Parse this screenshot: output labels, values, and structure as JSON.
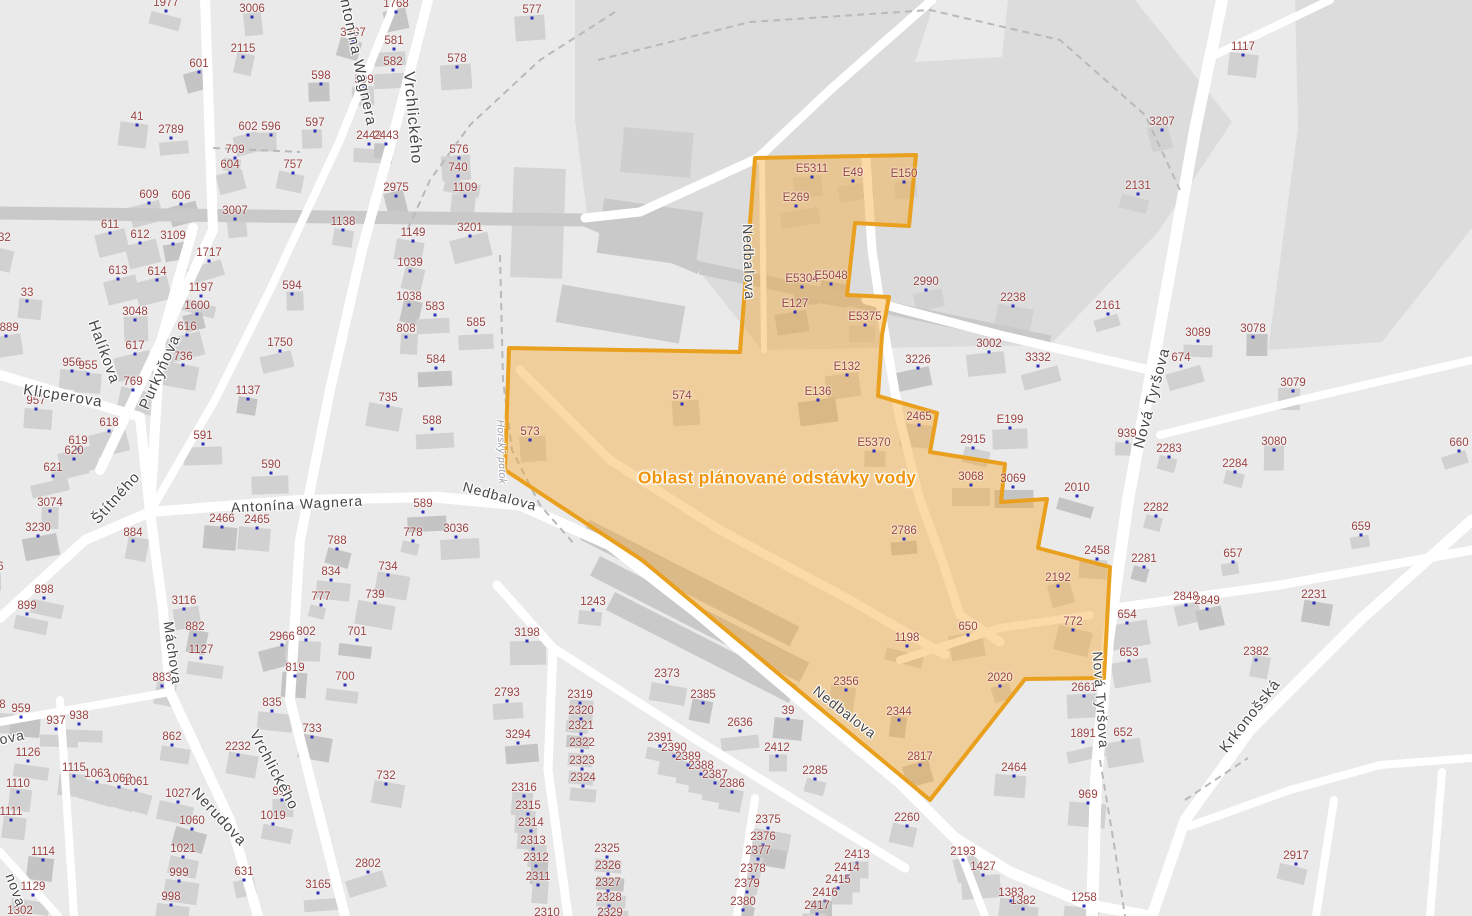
{
  "map": {
    "outage": {
      "label": "Oblast plánované odstávky vody",
      "x": 777,
      "y": 478
    },
    "colors": {
      "background": "#eaeaea",
      "zone_dark": "#dcdcdc",
      "street_white": "#ffffff",
      "road_gray": "#c9c9c9",
      "dashed_path": "#b9b9b9",
      "building": "#d1d1d1",
      "building_dark": "#c4c4c4",
      "parcel_text": "#9a4141",
      "marker_dot": "#2e2eb8",
      "street_text": "#454545",
      "outage_fill": "rgba(245,167,45,0.42)",
      "outage_border": "#e9a01e",
      "outage_text": "#f0950c"
    },
    "street_labels": [
      {
        "t": "Antonína Wagnera",
        "x": 357,
        "y": 57,
        "r": 78,
        "s": 15
      },
      {
        "t": "Vrchlického",
        "x": 412,
        "y": 118,
        "r": 85,
        "s": 16
      },
      {
        "t": "Halíkova",
        "x": 104,
        "y": 352,
        "r": 70,
        "s": 15
      },
      {
        "t": "Purkyňova",
        "x": 160,
        "y": 372,
        "r": -66,
        "s": 15
      },
      {
        "t": "Klicperova",
        "x": 63,
        "y": 396,
        "r": 9,
        "s": 15
      },
      {
        "t": "Štítného",
        "x": 116,
        "y": 498,
        "r": -48,
        "s": 15
      },
      {
        "t": "Antonína Wagnera",
        "x": 297,
        "y": 504,
        "r": -3,
        "s": 14
      },
      {
        "t": "Nedbalova",
        "x": 500,
        "y": 496,
        "r": 15,
        "s": 14
      },
      {
        "t": "Nedbalova",
        "x": 749,
        "y": 262,
        "r": 88,
        "s": 14
      },
      {
        "t": "Nedbalova",
        "x": 845,
        "y": 712,
        "r": 38,
        "s": 14
      },
      {
        "t": "Nová Tyršova",
        "x": 1152,
        "y": 398,
        "r": -75,
        "s": 15
      },
      {
        "t": "Nová Tyršova",
        "x": 1101,
        "y": 700,
        "r": 86,
        "s": 14
      },
      {
        "t": "Krkonošská",
        "x": 1250,
        "y": 716,
        "r": -52,
        "s": 15
      },
      {
        "t": "Nerudova",
        "x": 219,
        "y": 817,
        "r": 47,
        "s": 15
      },
      {
        "t": "Vrchlického",
        "x": 274,
        "y": 770,
        "r": 62,
        "s": 15
      },
      {
        "t": "Máchova",
        "x": 173,
        "y": 653,
        "r": 82,
        "s": 14
      },
      {
        "t": "ova",
        "x": 12,
        "y": 737,
        "r": -12,
        "s": 14
      },
      {
        "t": "nova",
        "x": 16,
        "y": 890,
        "r": 70,
        "s": 14
      },
      {
        "t": "Horský potok",
        "x": 501,
        "y": 452,
        "r": 88,
        "s": 10,
        "water": true
      }
    ],
    "parcel_labels": [
      {
        "t": "1977",
        "x": 166,
        "y": 3
      },
      {
        "t": "3006",
        "x": 252,
        "y": 9
      },
      {
        "t": "2115",
        "x": 243,
        "y": 49
      },
      {
        "t": "601",
        "x": 199,
        "y": 64
      },
      {
        "t": "41",
        "x": 137,
        "y": 117
      },
      {
        "t": "2789",
        "x": 171,
        "y": 130
      },
      {
        "t": "602",
        "x": 248,
        "y": 127
      },
      {
        "t": "596",
        "x": 271,
        "y": 127
      },
      {
        "t": "709",
        "x": 235,
        "y": 150
      },
      {
        "t": "604",
        "x": 230,
        "y": 165
      },
      {
        "t": "757",
        "x": 293,
        "y": 165
      },
      {
        "t": "609",
        "x": 149,
        "y": 195
      },
      {
        "t": "606",
        "x": 181,
        "y": 196
      },
      {
        "t": "3007",
        "x": 235,
        "y": 211
      },
      {
        "t": "611",
        "x": 110,
        "y": 225
      },
      {
        "t": "1032",
        "x": -2,
        "y": 238
      },
      {
        "t": "612",
        "x": 140,
        "y": 235
      },
      {
        "t": "3109",
        "x": 173,
        "y": 236
      },
      {
        "t": "1717",
        "x": 209,
        "y": 253
      },
      {
        "t": "613",
        "x": 118,
        "y": 271
      },
      {
        "t": "614",
        "x": 157,
        "y": 272
      },
      {
        "t": "594",
        "x": 292,
        "y": 286
      },
      {
        "t": "1197",
        "x": 201,
        "y": 288
      },
      {
        "t": "1600",
        "x": 197,
        "y": 306
      },
      {
        "t": "3048",
        "x": 135,
        "y": 312
      },
      {
        "t": "2889",
        "x": 6,
        "y": 328
      },
      {
        "t": "616",
        "x": 187,
        "y": 327
      },
      {
        "t": "33",
        "x": 27,
        "y": 293
      },
      {
        "t": "617",
        "x": 135,
        "y": 346
      },
      {
        "t": "1750",
        "x": 280,
        "y": 343
      },
      {
        "t": "736",
        "x": 183,
        "y": 357
      },
      {
        "t": "956",
        "x": 72,
        "y": 363
      },
      {
        "t": "955",
        "x": 88,
        "y": 366
      },
      {
        "t": "769",
        "x": 133,
        "y": 382
      },
      {
        "t": "1137",
        "x": 248,
        "y": 391
      },
      {
        "t": "957",
        "x": 36,
        "y": 401
      },
      {
        "t": "618",
        "x": 109,
        "y": 423
      },
      {
        "t": "619",
        "x": 78,
        "y": 441
      },
      {
        "t": "620",
        "x": 74,
        "y": 451
      },
      {
        "t": "591",
        "x": 203,
        "y": 436
      },
      {
        "t": "621",
        "x": 53,
        "y": 468
      },
      {
        "t": "590",
        "x": 271,
        "y": 465
      },
      {
        "t": "3074",
        "x": 50,
        "y": 503
      },
      {
        "t": "3230",
        "x": 38,
        "y": 528
      },
      {
        "t": "326",
        "x": -6,
        "y": 567
      },
      {
        "t": "898",
        "x": 44,
        "y": 590
      },
      {
        "t": "899",
        "x": 27,
        "y": 606
      },
      {
        "t": "884",
        "x": 133,
        "y": 533
      },
      {
        "t": "2466",
        "x": 222,
        "y": 519
      },
      {
        "t": "2465",
        "x": 257,
        "y": 520
      },
      {
        "t": "3116",
        "x": 184,
        "y": 601
      },
      {
        "t": "882",
        "x": 195,
        "y": 627
      },
      {
        "t": "1127",
        "x": 201,
        "y": 650
      },
      {
        "t": "883",
        "x": 162,
        "y": 678
      },
      {
        "t": "2966",
        "x": 282,
        "y": 637
      },
      {
        "t": "819",
        "x": 295,
        "y": 668
      },
      {
        "t": "802",
        "x": 306,
        "y": 632
      },
      {
        "t": "835",
        "x": 272,
        "y": 703
      },
      {
        "t": "958",
        "x": -4,
        "y": 705
      },
      {
        "t": "959",
        "x": 21,
        "y": 709
      },
      {
        "t": "937",
        "x": 56,
        "y": 721
      },
      {
        "t": "938",
        "x": 79,
        "y": 716
      },
      {
        "t": "1126",
        "x": 28,
        "y": 753
      },
      {
        "t": "1110",
        "x": 18,
        "y": 784
      },
      {
        "t": "1111",
        "x": 11,
        "y": 812
      },
      {
        "t": "1115",
        "x": 74,
        "y": 768
      },
      {
        "t": "1063",
        "x": 97,
        "y": 774
      },
      {
        "t": "1062",
        "x": 119,
        "y": 779
      },
      {
        "t": "1061",
        "x": 136,
        "y": 782
      },
      {
        "t": "1114",
        "x": 43,
        "y": 852
      },
      {
        "t": "1129",
        "x": 33,
        "y": 887
      },
      {
        "t": "1302",
        "x": 20,
        "y": 911
      },
      {
        "t": "862",
        "x": 172,
        "y": 737
      },
      {
        "t": "1027",
        "x": 178,
        "y": 794
      },
      {
        "t": "1060",
        "x": 192,
        "y": 821
      },
      {
        "t": "1021",
        "x": 183,
        "y": 849
      },
      {
        "t": "999",
        "x": 179,
        "y": 873
      },
      {
        "t": "998",
        "x": 171,
        "y": 897
      },
      {
        "t": "2232",
        "x": 238,
        "y": 747
      },
      {
        "t": "914",
        "x": 282,
        "y": 792
      },
      {
        "t": "1019",
        "x": 273,
        "y": 816
      },
      {
        "t": "631",
        "x": 244,
        "y": 872
      },
      {
        "t": "732",
        "x": 386,
        "y": 776
      },
      {
        "t": "3165",
        "x": 318,
        "y": 885
      },
      {
        "t": "2802",
        "x": 368,
        "y": 864
      },
      {
        "t": "700",
        "x": 345,
        "y": 677
      },
      {
        "t": "733",
        "x": 312,
        "y": 729
      },
      {
        "t": "3307",
        "x": 353,
        "y": 33
      },
      {
        "t": "1768",
        "x": 396,
        "y": 4
      },
      {
        "t": "581",
        "x": 394,
        "y": 41
      },
      {
        "t": "582",
        "x": 393,
        "y": 62
      },
      {
        "t": "598",
        "x": 321,
        "y": 76
      },
      {
        "t": "599",
        "x": 364,
        "y": 80
      },
      {
        "t": "597",
        "x": 315,
        "y": 123
      },
      {
        "t": "2442",
        "x": 369,
        "y": 136
      },
      {
        "t": "2443",
        "x": 386,
        "y": 136
      },
      {
        "t": "577",
        "x": 532,
        "y": 10
      },
      {
        "t": "578",
        "x": 457,
        "y": 59
      },
      {
        "t": "576",
        "x": 459,
        "y": 150
      },
      {
        "t": "740",
        "x": 458,
        "y": 168
      },
      {
        "t": "1109",
        "x": 465,
        "y": 188
      },
      {
        "t": "2975",
        "x": 396,
        "y": 188
      },
      {
        "t": "1138",
        "x": 343,
        "y": 222
      },
      {
        "t": "3201",
        "x": 470,
        "y": 228
      },
      {
        "t": "1149",
        "x": 413,
        "y": 233
      },
      {
        "t": "1039",
        "x": 410,
        "y": 263
      },
      {
        "t": "1038",
        "x": 409,
        "y": 297
      },
      {
        "t": "583",
        "x": 435,
        "y": 307
      },
      {
        "t": "808",
        "x": 406,
        "y": 329
      },
      {
        "t": "585",
        "x": 476,
        "y": 323
      },
      {
        "t": "584",
        "x": 436,
        "y": 360
      },
      {
        "t": "735",
        "x": 388,
        "y": 398
      },
      {
        "t": "588",
        "x": 432,
        "y": 421
      },
      {
        "t": "573",
        "x": 530,
        "y": 432
      },
      {
        "t": "589",
        "x": 423,
        "y": 504
      },
      {
        "t": "778",
        "x": 413,
        "y": 533
      },
      {
        "t": "3036",
        "x": 456,
        "y": 529
      },
      {
        "t": "788",
        "x": 337,
        "y": 541
      },
      {
        "t": "834",
        "x": 331,
        "y": 572
      },
      {
        "t": "734",
        "x": 388,
        "y": 567
      },
      {
        "t": "739",
        "x": 375,
        "y": 595
      },
      {
        "t": "777",
        "x": 321,
        "y": 597
      },
      {
        "t": "701",
        "x": 357,
        "y": 632
      },
      {
        "t": "3198",
        "x": 527,
        "y": 633
      },
      {
        "t": "2793",
        "x": 507,
        "y": 693
      },
      {
        "t": "3294",
        "x": 518,
        "y": 735
      },
      {
        "t": "1243",
        "x": 593,
        "y": 602
      },
      {
        "t": "2373",
        "x": 667,
        "y": 674
      },
      {
        "t": "2385",
        "x": 703,
        "y": 695
      },
      {
        "t": "2319",
        "x": 580,
        "y": 695
      },
      {
        "t": "2320",
        "x": 581,
        "y": 711
      },
      {
        "t": "2321",
        "x": 581,
        "y": 726
      },
      {
        "t": "2322",
        "x": 582,
        "y": 743
      },
      {
        "t": "2323",
        "x": 582,
        "y": 761
      },
      {
        "t": "2324",
        "x": 583,
        "y": 778
      },
      {
        "t": "2391",
        "x": 660,
        "y": 738
      },
      {
        "t": "2390",
        "x": 674,
        "y": 748
      },
      {
        "t": "2389",
        "x": 688,
        "y": 757
      },
      {
        "t": "2388",
        "x": 701,
        "y": 766
      },
      {
        "t": "2387",
        "x": 715,
        "y": 775
      },
      {
        "t": "2386",
        "x": 732,
        "y": 784
      },
      {
        "t": "2636",
        "x": 740,
        "y": 723
      },
      {
        "t": "39",
        "x": 788,
        "y": 711
      },
      {
        "t": "2412",
        "x": 777,
        "y": 748
      },
      {
        "t": "2285",
        "x": 815,
        "y": 771
      },
      {
        "t": "2356",
        "x": 846,
        "y": 682
      },
      {
        "t": "2344",
        "x": 899,
        "y": 712
      },
      {
        "t": "2316",
        "x": 524,
        "y": 788
      },
      {
        "t": "2315",
        "x": 528,
        "y": 806
      },
      {
        "t": "2314",
        "x": 531,
        "y": 823
      },
      {
        "t": "2313",
        "x": 533,
        "y": 841
      },
      {
        "t": "2312",
        "x": 536,
        "y": 858
      },
      {
        "t": "2311",
        "x": 538,
        "y": 877
      },
      {
        "t": "2310",
        "x": 547,
        "y": 913
      },
      {
        "t": "2325",
        "x": 607,
        "y": 849
      },
      {
        "t": "2326",
        "x": 608,
        "y": 866
      },
      {
        "t": "2327",
        "x": 608,
        "y": 883
      },
      {
        "t": "2328",
        "x": 609,
        "y": 898
      },
      {
        "t": "2329",
        "x": 610,
        "y": 913
      },
      {
        "t": "2375",
        "x": 768,
        "y": 820
      },
      {
        "t": "2376",
        "x": 763,
        "y": 837
      },
      {
        "t": "2377",
        "x": 758,
        "y": 851
      },
      {
        "t": "2378",
        "x": 753,
        "y": 869
      },
      {
        "t": "2379",
        "x": 747,
        "y": 884
      },
      {
        "t": "2380",
        "x": 743,
        "y": 902
      },
      {
        "t": "2413",
        "x": 857,
        "y": 855
      },
      {
        "t": "2414",
        "x": 847,
        "y": 868
      },
      {
        "t": "2415",
        "x": 838,
        "y": 880
      },
      {
        "t": "2416",
        "x": 825,
        "y": 893
      },
      {
        "t": "2417",
        "x": 817,
        "y": 906
      },
      {
        "t": "2260",
        "x": 907,
        "y": 818
      },
      {
        "t": "2193",
        "x": 963,
        "y": 852
      },
      {
        "t": "1427",
        "x": 983,
        "y": 867
      },
      {
        "t": "1383",
        "x": 1011,
        "y": 893
      },
      {
        "t": "1382",
        "x": 1023,
        "y": 901
      },
      {
        "t": "1258",
        "x": 1084,
        "y": 898
      },
      {
        "t": "969",
        "x": 1088,
        "y": 795
      },
      {
        "t": "E5311",
        "x": 812,
        "y": 169
      },
      {
        "t": "E49",
        "x": 853,
        "y": 173
      },
      {
        "t": "E150",
        "x": 904,
        "y": 174
      },
      {
        "t": "E269",
        "x": 796,
        "y": 198
      },
      {
        "t": "E5304",
        "x": 802,
        "y": 279
      },
      {
        "t": "E5048",
        "x": 831,
        "y": 276
      },
      {
        "t": "E127",
        "x": 795,
        "y": 304
      },
      {
        "t": "E5375",
        "x": 865,
        "y": 317
      },
      {
        "t": "E132",
        "x": 847,
        "y": 367
      },
      {
        "t": "E136",
        "x": 818,
        "y": 392
      },
      {
        "t": "E5370",
        "x": 874,
        "y": 443
      },
      {
        "t": "574",
        "x": 682,
        "y": 396
      },
      {
        "t": "2786",
        "x": 904,
        "y": 531
      },
      {
        "t": "1198",
        "x": 907,
        "y": 638
      },
      {
        "t": "650",
        "x": 968,
        "y": 627
      },
      {
        "t": "772",
        "x": 1073,
        "y": 622
      },
      {
        "t": "2192",
        "x": 1058,
        "y": 578
      },
      {
        "t": "2020",
        "x": 1000,
        "y": 678
      },
      {
        "t": "2817",
        "x": 920,
        "y": 757
      },
      {
        "t": "3068",
        "x": 971,
        "y": 477
      },
      {
        "t": "3069",
        "x": 1013,
        "y": 479
      },
      {
        "t": "2990",
        "x": 926,
        "y": 282
      },
      {
        "t": "2238",
        "x": 1013,
        "y": 298
      },
      {
        "t": "2161",
        "x": 1108,
        "y": 306
      },
      {
        "t": "3002",
        "x": 989,
        "y": 344
      },
      {
        "t": "3332",
        "x": 1038,
        "y": 358
      },
      {
        "t": "3226",
        "x": 918,
        "y": 360
      },
      {
        "t": "2465",
        "x": 919,
        "y": 417
      },
      {
        "t": "E199",
        "x": 1010,
        "y": 420
      },
      {
        "t": "2915",
        "x": 973,
        "y": 440
      },
      {
        "t": "939",
        "x": 1127,
        "y": 434
      },
      {
        "t": "674",
        "x": 1181,
        "y": 358
      },
      {
        "t": "2283",
        "x": 1169,
        "y": 449
      },
      {
        "t": "3089",
        "x": 1198,
        "y": 333
      },
      {
        "t": "3078",
        "x": 1253,
        "y": 329
      },
      {
        "t": "3079",
        "x": 1293,
        "y": 383
      },
      {
        "t": "3080",
        "x": 1274,
        "y": 442
      },
      {
        "t": "2284",
        "x": 1235,
        "y": 464
      },
      {
        "t": "660",
        "x": 1459,
        "y": 443
      },
      {
        "t": "659",
        "x": 1361,
        "y": 527
      },
      {
        "t": "2010",
        "x": 1077,
        "y": 488
      },
      {
        "t": "2282",
        "x": 1156,
        "y": 508
      },
      {
        "t": "2458",
        "x": 1097,
        "y": 551
      },
      {
        "t": "2281",
        "x": 1144,
        "y": 559
      },
      {
        "t": "657",
        "x": 1233,
        "y": 554
      },
      {
        "t": "2848",
        "x": 1186,
        "y": 597
      },
      {
        "t": "2849",
        "x": 1207,
        "y": 601
      },
      {
        "t": "654",
        "x": 1127,
        "y": 615
      },
      {
        "t": "653",
        "x": 1129,
        "y": 653
      },
      {
        "t": "652",
        "x": 1123,
        "y": 733
      },
      {
        "t": "2661",
        "x": 1084,
        "y": 688
      },
      {
        "t": "1891",
        "x": 1083,
        "y": 734
      },
      {
        "t": "2464",
        "x": 1014,
        "y": 768
      },
      {
        "t": "2382",
        "x": 1256,
        "y": 652
      },
      {
        "t": "2231",
        "x": 1314,
        "y": 595
      },
      {
        "t": "2917",
        "x": 1296,
        "y": 856
      },
      {
        "t": "1117",
        "x": 1243,
        "y": 47
      },
      {
        "t": "3207",
        "x": 1162,
        "y": 122
      },
      {
        "t": "2131",
        "x": 1138,
        "y": 186
      }
    ]
  }
}
